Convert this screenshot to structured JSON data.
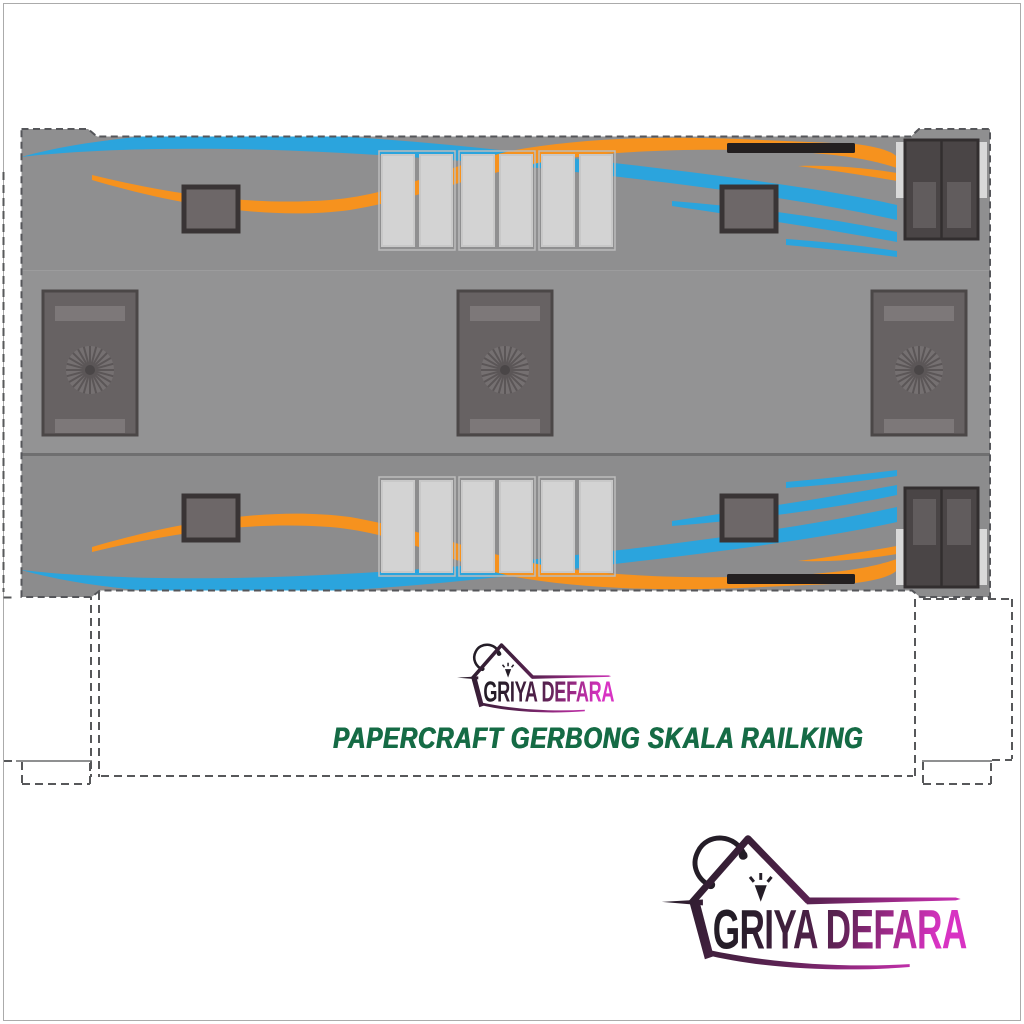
{
  "branding": {
    "brand_name": "GRIYA DEFARA",
    "tagline": "PAPERCRAFT GERBONG SKALA RAILKING"
  },
  "colors": {
    "accent_blue": "#2BA4DD",
    "accent_orange": "#F6921E",
    "body_gray_top": "#8F8F90",
    "body_gray_mid": "#939394",
    "body_gray_bottom": "#8C8C8D",
    "band_divider": "#6F6F70",
    "window_frame": "#393435",
    "window_fill": "#6D6768",
    "door_panel_light": "#D3D3D3",
    "end_door_dark": "#4A4546",
    "fan_panel": "#676263",
    "black_bar": "#231F20",
    "cut_line": "#57585A",
    "tagline_green": "#156B45",
    "logo_gradient_start": "#241D27",
    "logo_gradient_end": "#D833C3",
    "page_frame": "#ABABAB"
  },
  "icons": {
    "center_logo": "shopping-bag-house-icon",
    "footer_logo": "shopping-bag-house-icon",
    "sparkle": "click-sparkle-icon"
  }
}
